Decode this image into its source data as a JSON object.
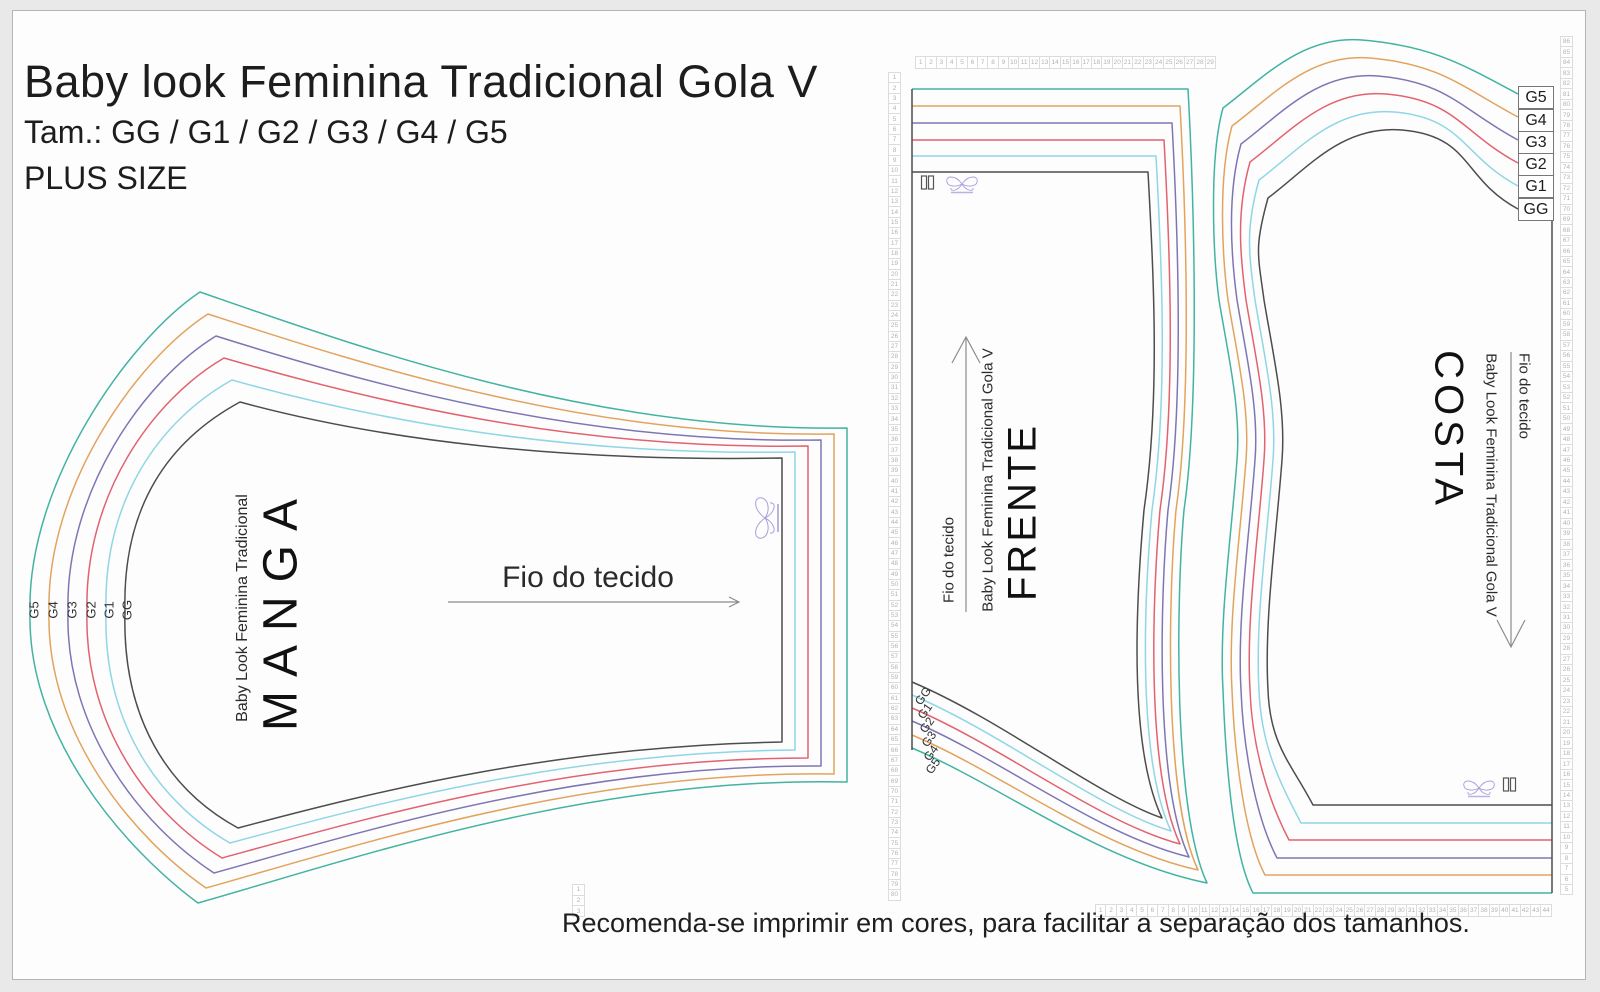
{
  "header": {
    "title": "Baby look Feminina Tradicional Gola V",
    "size_range": "Tam.: GG / G1 / G2 / G3 / G4 / G5",
    "plus": "PLUS SIZE"
  },
  "footer": {
    "note": "Recomenda-se imprimir em cores, para facilitar a separação dos tamanhos."
  },
  "sizes": [
    {
      "label": "GG",
      "color": "#4d4d4d"
    },
    {
      "label": "G1",
      "color": "#8fd6e6"
    },
    {
      "label": "G2",
      "color": "#e2626f"
    },
    {
      "label": "G3",
      "color": "#7e76b4"
    },
    {
      "label": "G4",
      "color": "#e2a35e"
    },
    {
      "label": "G5",
      "color": "#43b3a2"
    }
  ],
  "pieces": {
    "manga": {
      "name": "MANGA",
      "subtitle": "Baby Look Feminina Tradicional",
      "grainline": "Fio do tecido"
    },
    "frente": {
      "name": "FRENTE",
      "subtitle": "Baby Look Feminina Tradicional Gola V",
      "grainline": "Fio do tecido"
    },
    "costa": {
      "name": "COSTA",
      "subtitle": "Baby Look Feminina Tradicional Gola V",
      "grainline": "Fio do tecido"
    }
  },
  "rulers": {
    "left": {
      "count": 80,
      "start": 1,
      "step": 1
    },
    "top": {
      "count": 29,
      "start": 1,
      "step": 1
    },
    "right": {
      "count": 82,
      "start": 86,
      "step": -1
    },
    "bottom": {
      "count": 44,
      "start": 1,
      "step": 1
    },
    "mini": {
      "count": 3,
      "start": 1,
      "step": 1
    }
  }
}
